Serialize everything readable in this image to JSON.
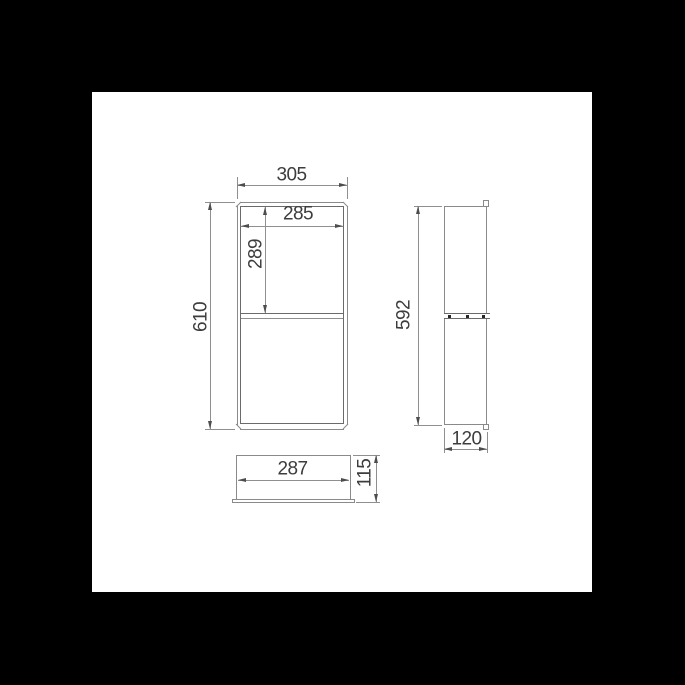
{
  "drawing": {
    "kind": "technical orthographic dimension drawing",
    "subject": "recessed wall niche with middle shelf (front, side, bottom views)",
    "units": "mm"
  },
  "colors": {
    "background": "#000000",
    "sheet": "#ffffff",
    "outline_line": "#8a8a8a",
    "detail_line": "#6b6b6b",
    "dimension_line": "#8f8f8f",
    "arrow": "#4d4d4d",
    "text": "#3d3d3d",
    "fastener_dot": "#262626"
  },
  "views": {
    "front": {
      "outer_width": "305",
      "inner_width": "285",
      "upper_opening_height": "289",
      "outer_height": "610"
    },
    "side": {
      "height": "592",
      "depth": "120"
    },
    "bottom": {
      "width": "287",
      "depth": "115"
    }
  }
}
